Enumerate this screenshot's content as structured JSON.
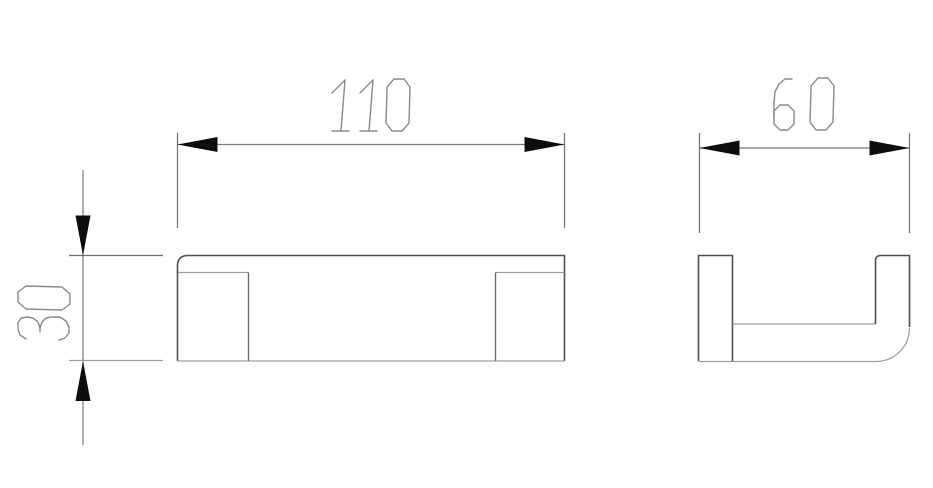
{
  "drawing": {
    "dimensions": {
      "width": {
        "label": "110"
      },
      "depth": {
        "label": "60"
      },
      "height": {
        "label": "30"
      }
    },
    "colors": {
      "background": "#ffffff",
      "line_dark": "#4f4f4f",
      "line_mid": "#6e6e6e",
      "line_light": "#9e9e9e",
      "dim_line": "#7a7a7a",
      "arrow_fill": "#0d0d0d",
      "text_stroke": "#8a8a8a"
    }
  }
}
